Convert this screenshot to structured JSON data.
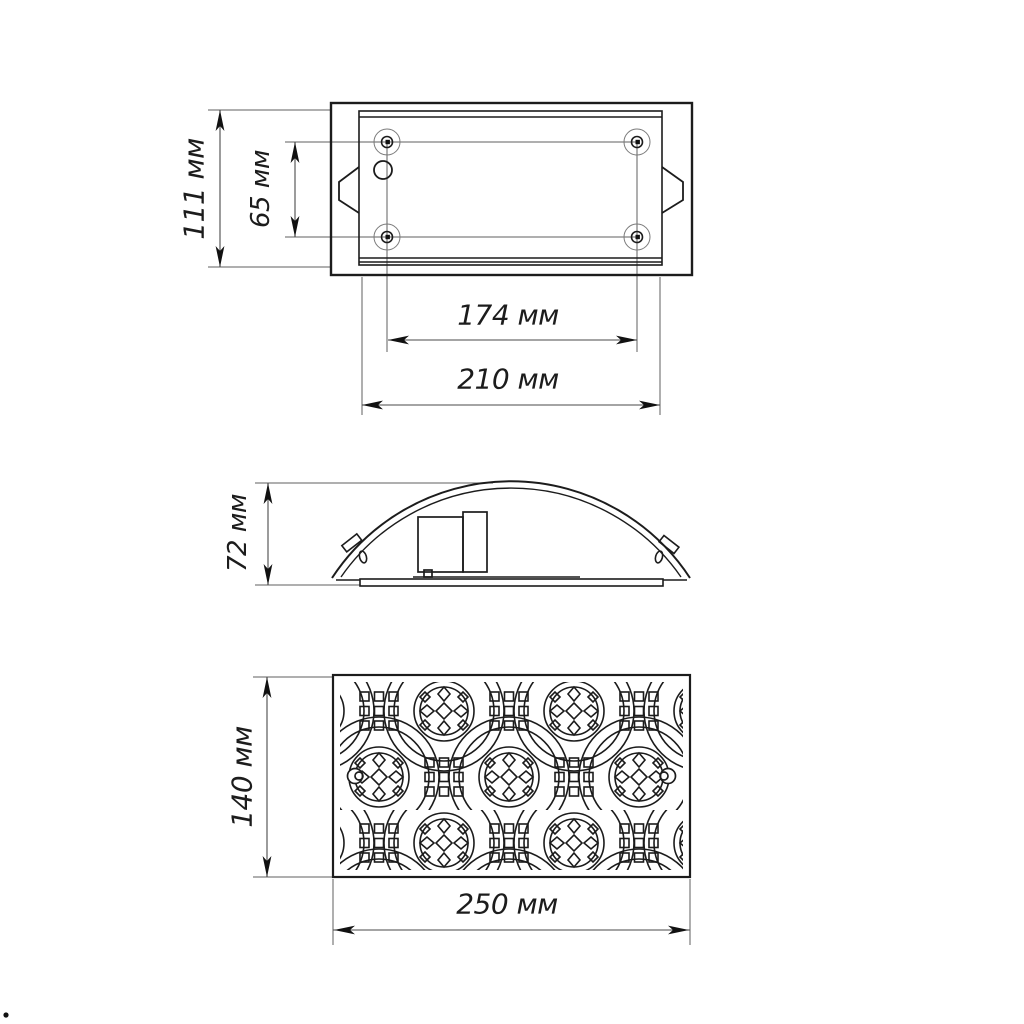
{
  "drawing": {
    "units_note": "мм",
    "colors": {
      "background": "#ffffff",
      "main_line": "#1c1c1c",
      "thin_line": "#5f5f5f",
      "arrow_fill": "#111111"
    },
    "dimensions": {
      "top_view": {
        "overall_height": "111 мм",
        "hole_spacing_vertical": "65 мм",
        "hole_spacing_horizontal": "174 мм",
        "body_width": "210 мм"
      },
      "side_view": {
        "height": "72 мм"
      },
      "front_view": {
        "height": "140 мм",
        "width": "250 мм"
      }
    }
  }
}
